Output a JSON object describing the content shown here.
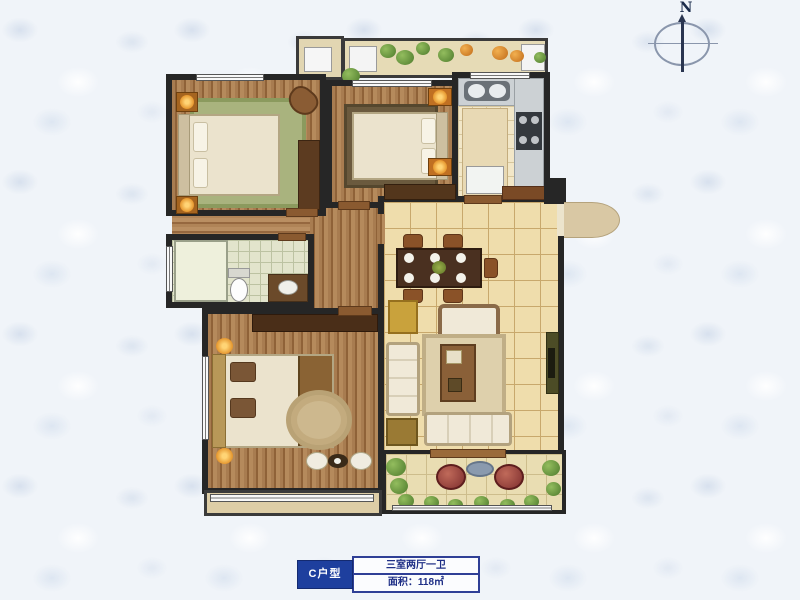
{
  "page": {
    "background_color": "#f0f4f9"
  },
  "compass": {
    "label": "N"
  },
  "info_plate": {
    "unit": "C户型",
    "layout": "三室两厅一卫",
    "area": "面积：118㎡",
    "plate_color": "#1e3f9e",
    "text_color": "#1f2f86"
  },
  "diagram": {
    "type": "floor-plan",
    "wall_color": "#262626",
    "rooms": [
      {
        "name": "bedroom-top-left",
        "floor": "wood",
        "furniture": [
          "double-bed",
          "nightstands-with-lamps",
          "green-rug",
          "chair",
          "wardrobe"
        ]
      },
      {
        "name": "bedroom-top-middle",
        "floor": "wood",
        "furniture": [
          "double-bed",
          "nightstands-with-lamps",
          "dark-rug",
          "dresser"
        ]
      },
      {
        "name": "kitchen",
        "floor": "tile",
        "furniture": [
          "sink-counter",
          "cooktop",
          "island",
          "fridge"
        ]
      },
      {
        "name": "bathroom",
        "floor": "tile",
        "furniture": [
          "shower",
          "toilet",
          "vanity"
        ]
      },
      {
        "name": "living-dining",
        "floor": "tile",
        "furniture": [
          "dining-table-with-chairs",
          "sofa-set",
          "coffee-table",
          "area-rug",
          "tv-stand",
          "entry-cabinet"
        ]
      },
      {
        "name": "master-bedroom",
        "floor": "wood",
        "furniture": [
          "double-bed",
          "lamps",
          "round-rug",
          "dresser",
          "stools"
        ]
      },
      {
        "name": "balcony-top",
        "floor": "tile",
        "furniture": [
          "planter-greens",
          "flowers",
          "ac-units"
        ]
      },
      {
        "name": "balcony-bottom",
        "floor": "tile",
        "furniture": [
          "potted-plants"
        ]
      },
      {
        "name": "bay-window",
        "floor": "sill"
      }
    ],
    "entry": "right-side-door-with-swing-arc"
  }
}
